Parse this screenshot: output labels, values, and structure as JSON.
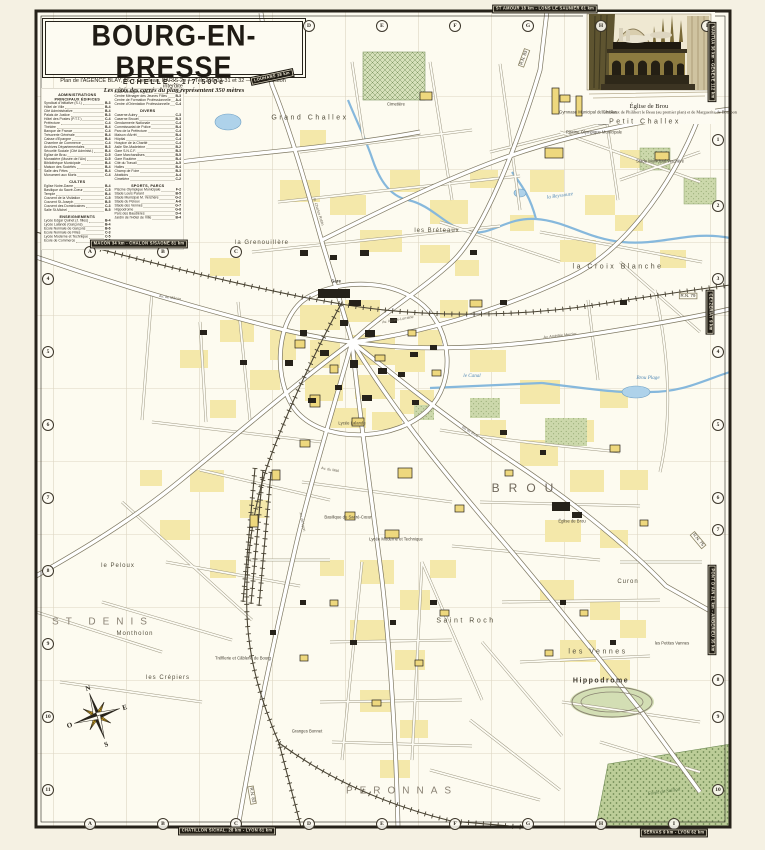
{
  "title_block": {
    "title": "BOURG-EN-BRESSE",
    "scale_label": "ÉCHELLE : 1/7.500e",
    "scale_note": "Les côtés des carrés du plan représentent 350 mètres",
    "publisher": "Plan de l'AGENCE BLAY, 26, r. Feydeau, PARIS-2e — Tél. 236-03-31 et 32 — Reproduction interdite"
  },
  "inset": {
    "caption_title": "Église de Brou",
    "caption_sub": "Tombeaux de Philibert le Beau (au premier plan) et de Marguerite de Bourbon"
  },
  "compass": {
    "n": "N",
    "e": "E",
    "s": "S",
    "o": "O"
  },
  "legend": {
    "columns": [
      [
        {
          "title_lines": [
            "ADMINISTRATIONS",
            "PRINCIPAUX ÉDIFICES"
          ],
          "items": [
            [
              "Syndicat d'Initiative (S.I.)",
              "B-3"
            ],
            [
              "Hôtel de Ville",
              "B-4"
            ],
            [
              "Cité Administrative",
              "B-4"
            ],
            [
              "Palais de Justice",
              "B-3"
            ],
            [
              "Hôtel des Postes (P.T.T.)",
              "C-4"
            ],
            [
              "Préfecture",
              "C-4"
            ],
            [
              "Théâtre",
              "B-4"
            ],
            [
              "Banque de France",
              "C-4"
            ],
            [
              "Trésorerie Générale",
              "B-4"
            ],
            [
              "Caisse d'Épargne",
              "B-4"
            ],
            [
              "Chambre de Commerce",
              "C-4"
            ],
            [
              "Archives Départementales",
              "B-3"
            ],
            [
              "Sécurité Sociale (Cité Administ.)",
              "B-4"
            ],
            [
              "Église de Brou",
              "D-5"
            ],
            [
              "Monastère (Musée de l'Ain)",
              "D-5"
            ],
            [
              "Bibliothèque Municipale",
              "B-4"
            ],
            [
              "Maison des Sociétés",
              "B-4"
            ],
            [
              "Salle des Fêtes",
              "B-4"
            ],
            [
              "Monument aux Morts",
              "C-4"
            ]
          ]
        },
        {
          "title_lines": [
            "CULTES"
          ],
          "items": [
            [
              "Église Notre-Dame",
              "B-4"
            ],
            [
              "Basilique du Sacré-Cœur",
              "C-5"
            ],
            [
              "Temple",
              "B-4"
            ],
            [
              "Couvent de la Visitation",
              "C-5"
            ],
            [
              "Couvent St-Joseph",
              "B-5"
            ],
            [
              "Couvent des Dominicaines",
              "C-3"
            ],
            [
              "Salle St-Michel",
              "B-5"
            ]
          ]
        },
        {
          "title_lines": [
            "ENSEIGNEMENTS"
          ],
          "items": [
            [
              "Lycée Edgar Quinet (J. filles)",
              "B-4"
            ],
            [
              "Lycée Lalande (Garçons)",
              "B-4"
            ],
            [
              "École Normale de Garçons",
              "B-6"
            ],
            [
              "École Normale de Filles",
              "C-3"
            ],
            [
              "Lycée Moderne et Technique",
              "C-5"
            ],
            [
              "École de Commerce",
              "B-5"
            ]
          ]
        }
      ],
      [
        {
          "title_lines": [],
          "items": [
            [
              "École Ménagère Agricole",
              "D-2"
            ],
            [
              "Centre Ménager des Jeunes Filles",
              "B-3"
            ],
            [
              "Centre de Formation Professionnelle",
              "A-4"
            ],
            [
              "Centre d'Orientation Professionnelle",
              "C-4"
            ]
          ]
        },
        {
          "title_lines": [
            "DIVERS"
          ],
          "items": [
            [
              "Caserne Aubry",
              "C-3"
            ],
            [
              "Caserne Brouet",
              "B-3"
            ],
            [
              "Gendarmerie Nationale",
              "C-4"
            ],
            [
              "Commissariat de Police",
              "B-4"
            ],
            [
              "Parc de la Préfecture",
              "C-4"
            ],
            [
              "Maison d'Arrêt",
              "B-4"
            ],
            [
              "Hôpital",
              "C-4"
            ],
            [
              "Hospice de la Charité",
              "C-4"
            ],
            [
              "Asile Ste-Madeleine",
              "B-2"
            ],
            [
              "Gare S.N.C.F.",
              "B-3"
            ],
            [
              "Gare Marchandises",
              "B-5"
            ],
            [
              "Gare Routière",
              "B-4"
            ],
            [
              "Cité du Travail",
              "A-5"
            ],
            [
              "Halles",
              "B-4"
            ],
            [
              "Champ de Foire",
              "B-3"
            ],
            [
              "Abattoirs",
              "A-4"
            ],
            [
              "Cimetière",
              "C-2"
            ]
          ]
        },
        {
          "title_lines": [
            "SPORTS, PARCS"
          ],
          "items": [
            [
              "Piscine Olympique Municipale",
              "F-2"
            ],
            [
              "Stade Louis Parant",
              "B-5"
            ],
            [
              "Stade Municipal M. Verchère",
              "G-2"
            ],
            [
              "Stade du Peloux",
              "A-6"
            ],
            [
              "Stade des Vennes",
              "G-7"
            ],
            [
              "Hippodrome",
              "G-8"
            ],
            [
              "Parc des Baudières",
              "D-4"
            ],
            [
              "Jardin de l'Hôtel de Ville",
              "B-4"
            ]
          ]
        }
      ]
    ]
  },
  "grid": {
    "marks": [
      {
        "t": "D",
        "x": 309,
        "y": 26
      },
      {
        "t": "E",
        "x": 382,
        "y": 26
      },
      {
        "t": "F",
        "x": 455,
        "y": 26
      },
      {
        "t": "G",
        "x": 528,
        "y": 26
      },
      {
        "t": "H",
        "x": 601,
        "y": 26
      },
      {
        "t": "I",
        "x": 707,
        "y": 26
      },
      {
        "t": "A",
        "x": 90,
        "y": 824
      },
      {
        "t": "B",
        "x": 163,
        "y": 824
      },
      {
        "t": "C",
        "x": 236,
        "y": 824
      },
      {
        "t": "D",
        "x": 309,
        "y": 824
      },
      {
        "t": "E",
        "x": 382,
        "y": 824
      },
      {
        "t": "F",
        "x": 455,
        "y": 824
      },
      {
        "t": "G",
        "x": 528,
        "y": 824
      },
      {
        "t": "H",
        "x": 601,
        "y": 824
      },
      {
        "t": "I",
        "x": 674,
        "y": 824
      },
      {
        "t": "A",
        "x": 90,
        "y": 252
      },
      {
        "t": "B",
        "x": 163,
        "y": 252
      },
      {
        "t": "C",
        "x": 236,
        "y": 252
      },
      {
        "t": "4",
        "x": 48,
        "y": 279
      },
      {
        "t": "5",
        "x": 48,
        "y": 352
      },
      {
        "t": "6",
        "x": 48,
        "y": 425
      },
      {
        "t": "7",
        "x": 48,
        "y": 498
      },
      {
        "t": "8",
        "x": 48,
        "y": 571
      },
      {
        "t": "9",
        "x": 48,
        "y": 644
      },
      {
        "t": "10",
        "x": 48,
        "y": 717
      },
      {
        "t": "11",
        "x": 48,
        "y": 790
      },
      {
        "t": "1",
        "x": 718,
        "y": 140
      },
      {
        "t": "2",
        "x": 718,
        "y": 206
      },
      {
        "t": "3",
        "x": 718,
        "y": 279
      },
      {
        "t": "4",
        "x": 718,
        "y": 352
      },
      {
        "t": "5",
        "x": 718,
        "y": 425
      },
      {
        "t": "6",
        "x": 718,
        "y": 498
      },
      {
        "t": "7",
        "x": 718,
        "y": 530
      },
      {
        "t": "8",
        "x": 718,
        "y": 680
      },
      {
        "t": "9",
        "x": 718,
        "y": 717
      },
      {
        "t": "10",
        "x": 718,
        "y": 790
      }
    ]
  },
  "edge_badges": [
    {
      "t": "ST AMOUR 18 km - LONS LE SAUNIER 61 km",
      "x": 545,
      "y": 9,
      "rot": 0
    },
    {
      "t": "LOUHANS 38 km",
      "x": 272,
      "y": 77,
      "rot": -12
    },
    {
      "t": "MACON 34 km - CHALON S/SAONE 81 km",
      "x": 139,
      "y": 244,
      "rot": 0
    },
    {
      "t": "NANTUA 36 km - GENEVE 112 km",
      "x": 712,
      "y": 62,
      "rot": 90
    },
    {
      "t": "CEYZERIAT 9 km",
      "x": 710,
      "y": 312,
      "rot": 90
    },
    {
      "t": "PONT D'AIN 21 km - AMBERIEU 35 km",
      "x": 712,
      "y": 610,
      "rot": 90
    },
    {
      "t": "CHATILLON S/CHAL. 28 km - LYON 61 km",
      "x": 227,
      "y": 831,
      "rot": 0
    },
    {
      "t": "SERVAS 9 km - LYON 62 km",
      "x": 674,
      "y": 833,
      "rot": 0
    }
  ],
  "map_labels": [
    {
      "t": "Grand Challex",
      "x": 310,
      "y": 118,
      "c": "quarter"
    },
    {
      "t": "Petit Challex",
      "x": 645,
      "y": 122,
      "c": "quarter"
    },
    {
      "t": "la Croix Blanche",
      "x": 618,
      "y": 267,
      "c": "quarter"
    },
    {
      "t": "BROU",
      "x": 527,
      "y": 488,
      "c": "district-xl"
    },
    {
      "t": "Saint Roch",
      "x": 466,
      "y": 621,
      "c": "quarter"
    },
    {
      "t": "les Vennes",
      "x": 598,
      "y": 652,
      "c": "quarter"
    },
    {
      "t": "ST DENIS",
      "x": 103,
      "y": 622,
      "c": "district"
    },
    {
      "t": "PERONNAS",
      "x": 402,
      "y": 791,
      "c": "district"
    },
    {
      "t": "Curon",
      "x": 628,
      "y": 582,
      "c": "quarter-sm"
    },
    {
      "t": "le Peloux",
      "x": 118,
      "y": 566,
      "c": "quarter-sm"
    },
    {
      "t": "Montholon",
      "x": 135,
      "y": 634,
      "c": "quarter-sm"
    },
    {
      "t": "les Crépiers",
      "x": 168,
      "y": 678,
      "c": "quarter-sm"
    },
    {
      "t": "les Bréteaux",
      "x": 437,
      "y": 231,
      "c": "quarter-sm"
    },
    {
      "t": "la Grenouillère",
      "x": 262,
      "y": 243,
      "c": "quarter-sm"
    },
    {
      "t": "Hippodrome",
      "x": 601,
      "y": 681,
      "c": "place-bold"
    },
    {
      "t": "les Petites Vannes",
      "x": 672,
      "y": 644,
      "c": "tiny"
    },
    {
      "t": "Tréfilerie et Câblerie de Bourg",
      "x": 243,
      "y": 659,
      "c": "tiny"
    },
    {
      "t": "Granges Bonnet",
      "x": 307,
      "y": 732,
      "c": "tiny"
    },
    {
      "t": "Cimetière",
      "x": 396,
      "y": 105,
      "c": "tiny"
    },
    {
      "t": "Stade Municipal Verchère",
      "x": 660,
      "y": 162,
      "c": "tiny"
    },
    {
      "t": "Piscine Olympique Municipale",
      "x": 594,
      "y": 133,
      "c": "tiny"
    },
    {
      "t": "Gymnase Municipal de Challes",
      "x": 588,
      "y": 113,
      "c": "tiny"
    },
    {
      "t": "Gare",
      "x": 336,
      "y": 282,
      "c": "tiny-bold"
    },
    {
      "t": "Église de Brou",
      "x": 572,
      "y": 522,
      "c": "tiny"
    },
    {
      "t": "Basilique du Sacré-Cœur",
      "x": 348,
      "y": 518,
      "c": "tiny"
    },
    {
      "t": "Lycée Moderne et Technique",
      "x": 396,
      "y": 540,
      "c": "tiny"
    },
    {
      "t": "Lycée Lalande",
      "x": 352,
      "y": 424,
      "c": "tiny"
    },
    {
      "t": "Forêt de Seillon",
      "x": 664,
      "y": 792,
      "c": "green",
      "rot": -8
    },
    {
      "t": "la Reyssouze",
      "x": 560,
      "y": 196,
      "c": "water",
      "rot": -8
    },
    {
      "t": "Brou Plage",
      "x": 648,
      "y": 378,
      "c": "water"
    },
    {
      "t": "le Canal",
      "x": 472,
      "y": 376,
      "c": "water"
    },
    {
      "t": "R.N. 83",
      "x": 524,
      "y": 58,
      "c": "route",
      "rot": -70
    },
    {
      "t": "R.N. 79",
      "x": 688,
      "y": 296,
      "c": "route"
    },
    {
      "t": "R.N. 75",
      "x": 698,
      "y": 540,
      "c": "route",
      "rot": 50
    },
    {
      "t": "R.N. 83",
      "x": 252,
      "y": 795,
      "c": "route",
      "rot": 80
    },
    {
      "t": "Av. de Mâcon",
      "x": 170,
      "y": 298,
      "c": "street",
      "rot": 8
    },
    {
      "t": "Av. Alsace-Lorraine",
      "x": 398,
      "y": 320,
      "c": "street",
      "rot": -10
    },
    {
      "t": "Bd de Brou",
      "x": 470,
      "y": 432,
      "c": "street",
      "rot": 32
    },
    {
      "t": "Av. de Lyon",
      "x": 302,
      "y": 522,
      "c": "street",
      "rot": 78
    },
    {
      "t": "Av. du Mail",
      "x": 330,
      "y": 470,
      "c": "street",
      "rot": 10
    },
    {
      "t": "Av. Amédée Mercier",
      "x": 560,
      "y": 336,
      "c": "street",
      "rot": -6
    },
    {
      "t": "R. Charles Robin",
      "x": 318,
      "y": 212,
      "c": "street",
      "rot": 72
    }
  ]
}
